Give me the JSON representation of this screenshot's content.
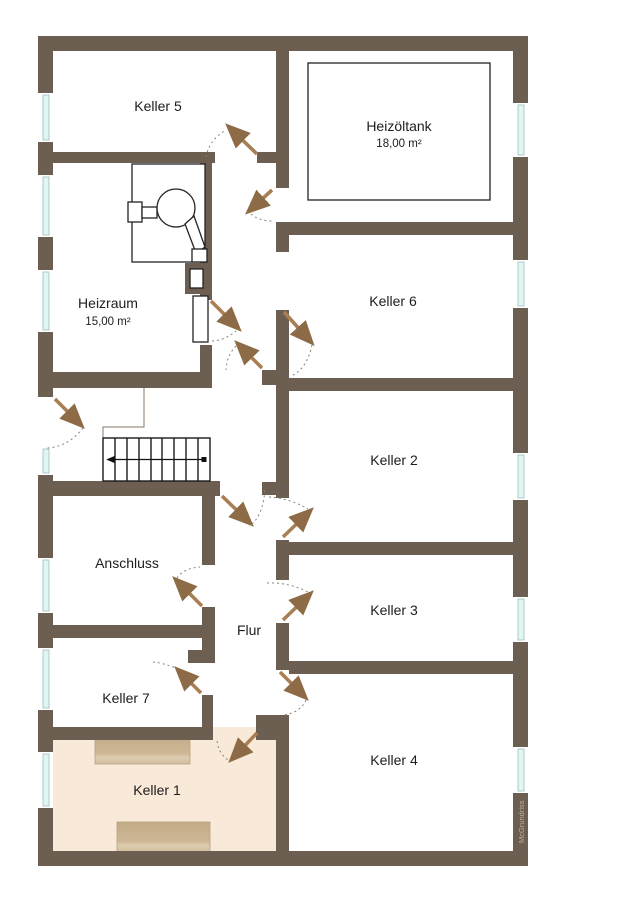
{
  "plan": {
    "title": "Kellergeschoss Grundriss",
    "watermark": "McGrundriss",
    "rooms": {
      "keller5": {
        "label": "Keller 5"
      },
      "heizoeltank": {
        "label": "Heizöltank",
        "area": "18,00 m²"
      },
      "heizraum": {
        "label": "Heizraum",
        "area": "15,00 m²"
      },
      "keller6": {
        "label": "Keller 6"
      },
      "keller2": {
        "label": "Keller 2"
      },
      "keller3": {
        "label": "Keller 3"
      },
      "keller4": {
        "label": "Keller 4"
      },
      "anschluss": {
        "label": "Anschluss"
      },
      "flur": {
        "label": "Flur"
      },
      "keller7": {
        "label": "Keller 7"
      },
      "keller1": {
        "label": "Keller 1"
      }
    },
    "colors": {
      "wall": "#6c5f51",
      "door_leaf": "#a87f54",
      "door_arrow": "#8d6b47",
      "window_glass": "#dff6f3",
      "keller1_floor": "#f9e9d8",
      "furniture": "#c9b494",
      "watermark_text": "#b9b0a3"
    }
  }
}
